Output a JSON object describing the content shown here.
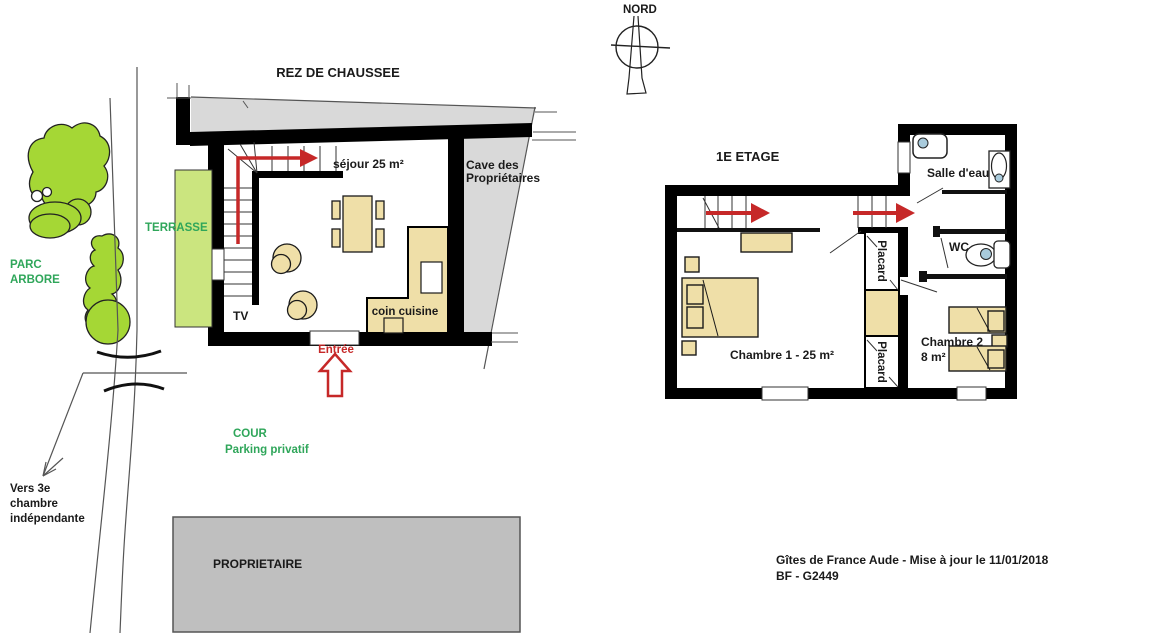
{
  "colors": {
    "wall_black": "#000000",
    "furniture_beige": "#EFDFA8",
    "area_gray": "#D9D9D9",
    "proprietaire_gray": "#BFBFBF",
    "terrasse_green": "#CBE57F",
    "tree_green": "#A5D735",
    "label_green": "#2FA65A",
    "arrow_red": "#C62828",
    "fixture_blue": "#A9CBDC"
  },
  "compass": {
    "label": "NORD"
  },
  "ground_floor": {
    "title": "REZ DE CHAUSSEE",
    "sejour_label": "séjour 25 m²",
    "cave_label": [
      "Cave des",
      "Propriétaires"
    ],
    "terrasse_label": "TERRASSE",
    "parc_label": [
      "PARC",
      "ARBORE"
    ],
    "tv_label": "TV",
    "kitchen_label": "coin cuisine",
    "entree_label": "Entrée",
    "cour_label": "COUR",
    "parking_label": "Parking privatif",
    "vers_label": [
      "Vers 3e",
      "chambre",
      "indépendante"
    ],
    "proprietaire_label": "PROPRIETAIRE"
  },
  "first_floor": {
    "title": "1E ETAGE",
    "salle_eau_label": "Salle d'eau",
    "wc_label": "WC",
    "placard_upper_label": "Placard",
    "placard_lower_label": "Placard",
    "chambre1_label": "Chambre 1 - 25 m²",
    "chambre2_label": "Chambre 2",
    "chambre2_area": "8 m²"
  },
  "footer": {
    "line1": "Gîtes de France Aude - Mise à jour le 11/01/2018",
    "line2": "BF  - G2449"
  }
}
